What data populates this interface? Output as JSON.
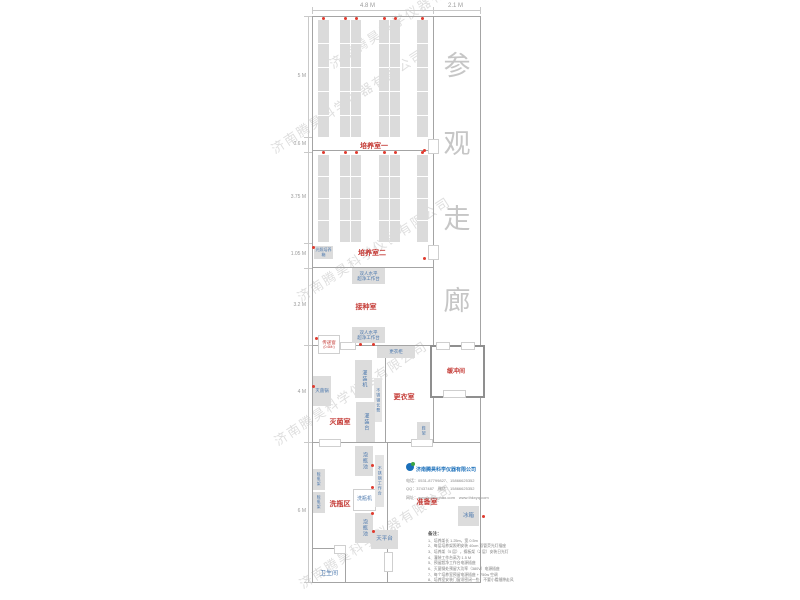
{
  "watermark": {
    "text": "济南腾昊科学仪器有限公司"
  },
  "corridor": {
    "label": "参观走廊",
    "chars": [
      "参",
      "观",
      "走",
      "廊"
    ]
  },
  "dimensions": {
    "top": {
      "main_width": "4.8 M",
      "corridor_width": "2.1 M"
    },
    "left": [
      "5 M",
      "0.6 M",
      "3.75 M",
      "1.05 M",
      "3.2 M",
      "4 M",
      "6 M"
    ]
  },
  "rooms": {
    "culture_room_1": "培养室一",
    "culture_room_2": "培养室二",
    "inoculation_room": "接种室",
    "sterilization_room": "灭菌室",
    "changing_room": "更衣室",
    "buffer_room": "缓冲间",
    "bottle_washing_area": "洗瓶区",
    "preparation_room": "准备室",
    "toilet": "卫生间"
  },
  "equipment": {
    "light_incubator": "光照培养箱",
    "clean_bench_line1": "双人水平",
    "clean_bench_line2": "超净工作台",
    "pass_window": "传递窗",
    "pass_window_area": "(0.6M²)",
    "locker": "更衣柜",
    "filling_machine": "灌装机",
    "stainless_bench": "不锈钢长凳",
    "sterilizer": "灭菌锅",
    "filling_table": "灌装台",
    "shoe_rack": "鞋架",
    "soak_pool": "泡瓶池",
    "stainless_worktable": "不锈钢工作台",
    "bottle_washer": "洗瓶机",
    "balance_table": "天平台",
    "fridge": "冰箱",
    "bottle_rack": "晾瓶架"
  },
  "company": {
    "name": "济南腾昊科学仪器有限公司",
    "phone_line": "电话：0531-87799827、15866625352",
    "qq_line": "QQ：37437487　微信：15866625352",
    "web_line": "网址：www.sdtenghao.com　www.thkxyq.com"
  },
  "notes": {
    "title": "备注：",
    "items": [
      "1、培养架长 1.25m，宽 0.5m",
      "2、每层培养架照明安装 40cm 双管荧光灯插座",
      "3、培养架（5 层），搁板架（2 层）安装日光灯",
      "4、灌装工作台高为 1.5 M",
      "5、预留超净工作台电源插座",
      "6、灭菌锅处预留大功率（380V）电源插座",
      "7、每个培养室预留电源插座 + 750w 空调",
      "8、培养室安装门窗须密闭一些，不要小看缝隙走风"
    ]
  }
}
